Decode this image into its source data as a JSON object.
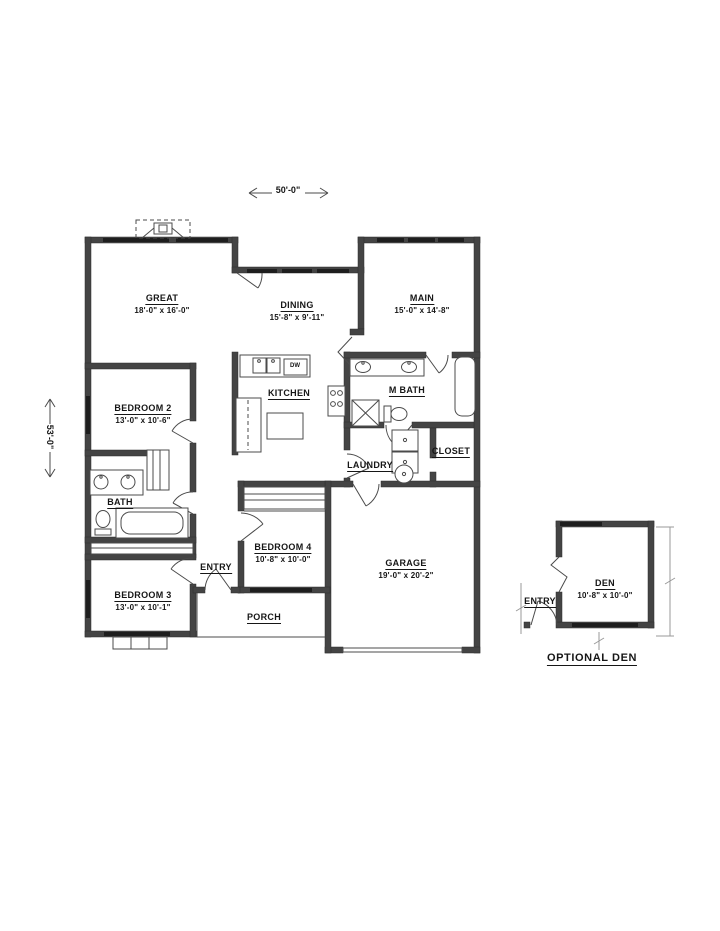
{
  "colors": {
    "wall": "#444444",
    "line": "#4b4b4b",
    "window": "#1e1e1e",
    "text": "#161616",
    "background": "#ffffff"
  },
  "dimensions": {
    "width": "50'-0\"",
    "height": "53'-0\""
  },
  "labels": {
    "dw": "DW",
    "optional_den": "OPTIONAL DEN"
  },
  "rooms": {
    "great": {
      "name": "GREAT",
      "dims": "18'-0\" x 16'-0\""
    },
    "dining": {
      "name": "DINING",
      "dims": "15'-8\" x 9'-11\""
    },
    "main": {
      "name": "MAIN",
      "dims": "15'-0\" x 14'-8\""
    },
    "kitchen": {
      "name": "KITCHEN"
    },
    "m_bath": {
      "name": "M BATH"
    },
    "bedroom2": {
      "name": "BEDROOM 2",
      "dims": "13'-0\" x 10'-6\""
    },
    "bath": {
      "name": "BATH"
    },
    "laundry": {
      "name": "LAUNDRY"
    },
    "closet": {
      "name": "CLOSET"
    },
    "bedroom4": {
      "name": "BEDROOM 4",
      "dims": "10'-8\" x 10'-0\""
    },
    "entry": {
      "name": "ENTRY"
    },
    "garage": {
      "name": "GARAGE",
      "dims": "19'-0\" x 20'-2\""
    },
    "bedroom3": {
      "name": "BEDROOM 3",
      "dims": "13'-0\" x 10'-1\""
    },
    "porch": {
      "name": "PORCH"
    },
    "den": {
      "name": "DEN",
      "dims": "10'-8\" x 10'-0\""
    },
    "den_entry": {
      "name": "ENTRY"
    }
  }
}
